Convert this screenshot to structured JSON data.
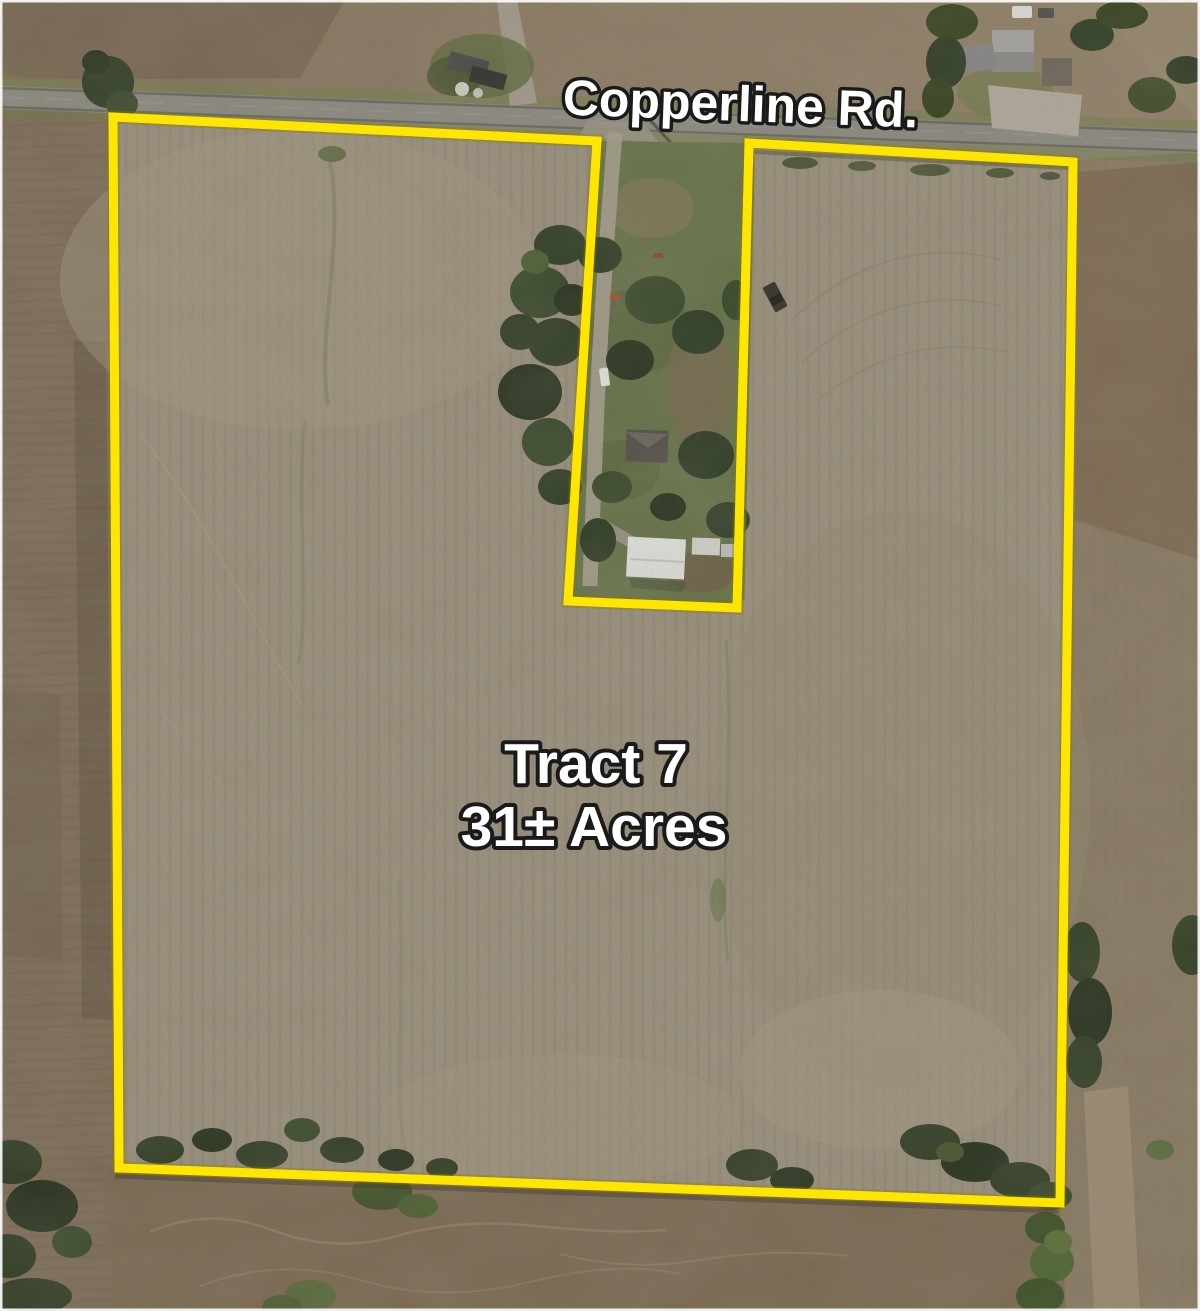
{
  "map": {
    "road_label": "Copperline Rd.",
    "tract_name": "Tract 7",
    "tract_acreage": "31± Acres",
    "boundary": {
      "color": "#FFE600",
      "points": "113,117 597,141 568,601 737,608 749,143 1073,162 1060,1203 119,1168"
    },
    "label_style": {
      "fill": "#FFFFFF",
      "outline": "#1A1A1A"
    }
  }
}
